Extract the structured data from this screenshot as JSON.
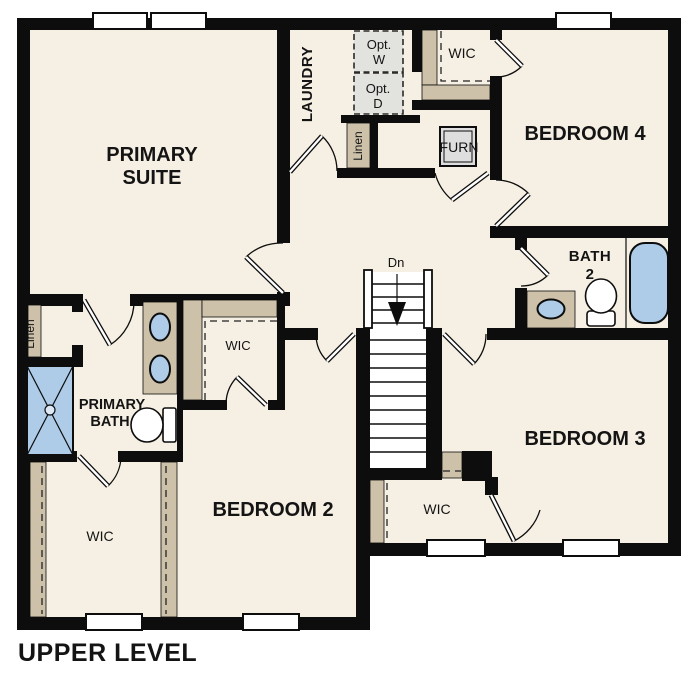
{
  "footer": {
    "title": "UPPER LEVEL"
  },
  "rooms": {
    "primary_suite": {
      "line1": "PRIMARY",
      "line2": "SUITE"
    },
    "laundry": {
      "label": "LAUNDRY"
    },
    "optional_washer": {
      "line1": "Opt.",
      "line2": "W"
    },
    "optional_dryer": {
      "line1": "Opt.",
      "line2": "D"
    },
    "linen_hall": {
      "label": "Linen"
    },
    "linen_bath": {
      "label": "Linen"
    },
    "wic_bedroom4": {
      "label": "WIC"
    },
    "wic_bedroom2": {
      "label": "WIC"
    },
    "wic_primary": {
      "label": "WIC"
    },
    "wic_bedroom3": {
      "label": "WIC"
    },
    "bedroom4": {
      "label": "BEDROOM 4"
    },
    "bedroom3": {
      "label": "BEDROOM 3"
    },
    "bedroom2": {
      "label": "BEDROOM 2"
    },
    "furnace": {
      "label": "FURN"
    },
    "bath2": {
      "line1": "BATH",
      "line2": "2"
    },
    "primary_bath": {
      "line1": "PRIMARY",
      "line2": "BATH"
    },
    "stairs": {
      "down_label": "Dn"
    }
  },
  "colors": {
    "floor": "#f6efe3",
    "wall": "#0d0d0d",
    "shelf": "#cdc1a9",
    "fixture_blue": "#aecbe8",
    "appliance_gray": "#e2e2df",
    "window_white": "#ffffff"
  }
}
